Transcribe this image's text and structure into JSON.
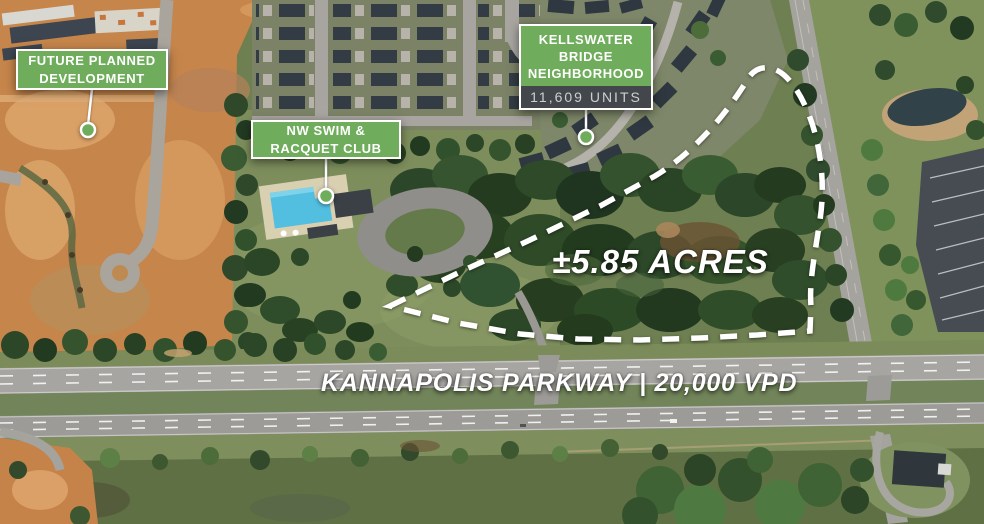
{
  "annotations": {
    "future_development": {
      "lines": [
        "FUTURE PLANNED",
        "DEVELOPMENT"
      ]
    },
    "swim_club": {
      "lines": [
        "NW SWIM &",
        "RACQUET CLUB"
      ]
    },
    "kellswater": {
      "lines": [
        "KELLSWATER",
        "BRIDGE",
        "NEIGHBORHOOD"
      ],
      "units": "11,609 UNITS"
    },
    "acreage": "±5.85 ACRES",
    "parkway": "KANNAPOLIS PARKWAY | 20,000 VPD"
  },
  "colors": {
    "label_green": "#6FAD5C",
    "units_bar": "#43474B",
    "annotation_white": "#FFFFFF"
  }
}
